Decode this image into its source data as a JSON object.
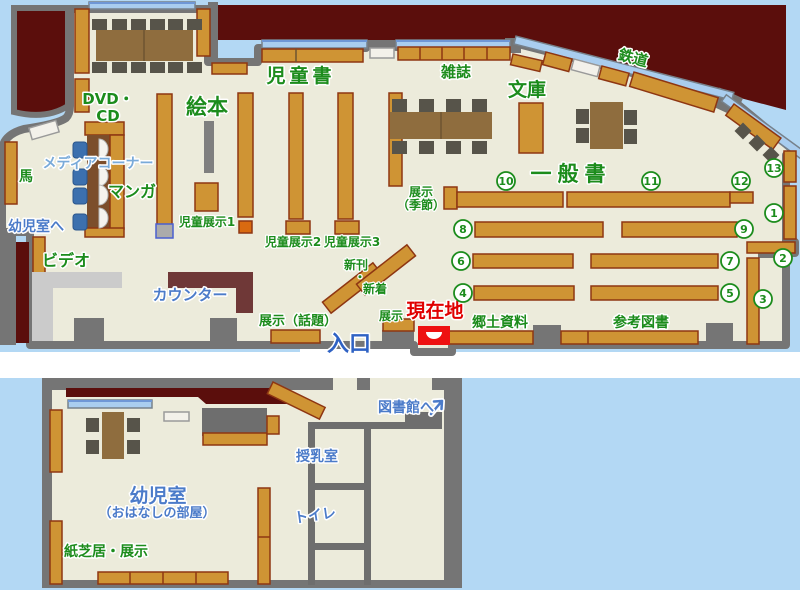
{
  "palette": {
    "background": "#b3d8f4",
    "floor": "#ecebdb",
    "wall_gray": "#757575",
    "closed_area_maroon": "#5b0e0c",
    "bookshelf_tan": "#cf9434",
    "bookshelf_border": "#8e3612",
    "table_brown": "#8f6d3e",
    "chair_gray": "#57544a",
    "counter_brown": "#6f3837",
    "window_blue": "#a9cdef",
    "label_green": "#1c8c1c",
    "label_blue": "#4b7bc9",
    "label_light_blue": "#79aad9",
    "current_location_red": "#e00000"
  },
  "main_map": {
    "labels": {
      "dvd_line1": "DVD・",
      "dvd_line2": "CD",
      "ehon": "絵本",
      "jidosho": "児童書",
      "zasshi": "雑誌",
      "bunko": "文庫",
      "tetsudo": "鉄道",
      "ippansho": "一般書",
      "media_corner": "メディアコーナー",
      "manga": "マンガ",
      "uma": "馬",
      "yojishitsu_e": "幼児室へ",
      "video": "ビデオ",
      "counter": "カウンター",
      "jido_tenji1": "児童展示1",
      "jido_tenji2": "児童展示2",
      "jido_tenji3": "児童展示3",
      "shinkan": "新刊",
      "nakaguro": "・",
      "shinchaku": "新着",
      "tenji_wadai": "展示（話題）",
      "tenji": "展示",
      "tenji_kisetsu_1": "展示",
      "tenji_kisetsu_2": "（季節）",
      "genzaichi": "現在地",
      "iriguchi": "入口",
      "kyodo_shiryo": "郷土資料",
      "sanko_tosho": "参考図書"
    },
    "shelf_numbers": [
      "1",
      "2",
      "3",
      "4",
      "5",
      "6",
      "7",
      "8",
      "9",
      "10",
      "11",
      "12",
      "13"
    ]
  },
  "annex_map": {
    "labels": {
      "yojishitsu": "幼児室",
      "ohanashi": "（おはなしの部屋）",
      "kamishibai": "紙芝居・展示",
      "junyushitsu": "授乳室",
      "toire": "トイレ",
      "toshokan_e": "図書館へ"
    }
  }
}
